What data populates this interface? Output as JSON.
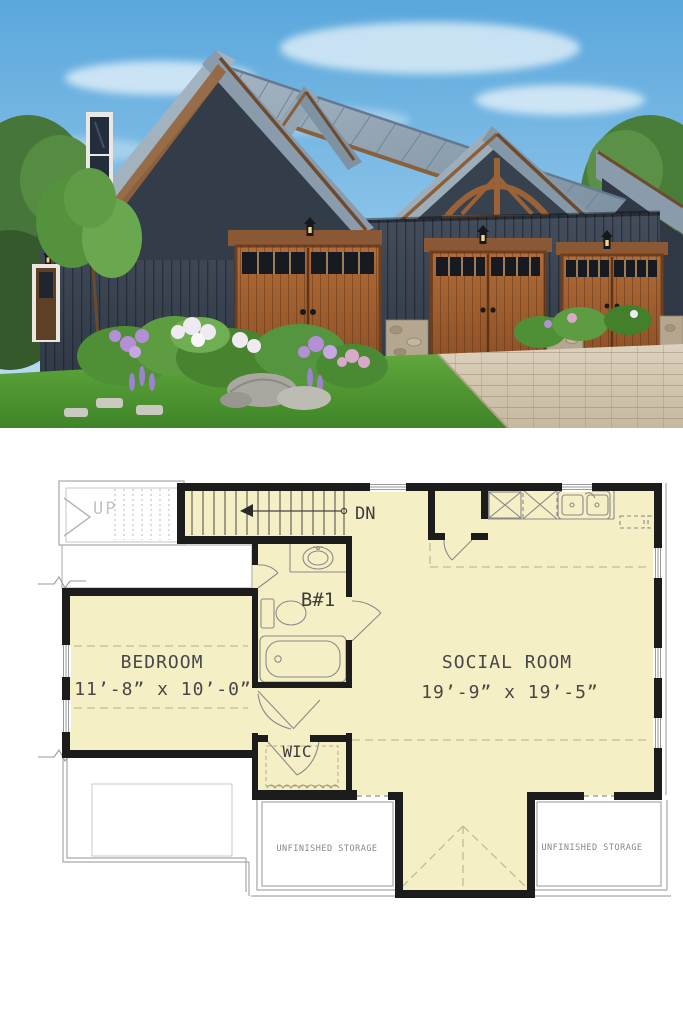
{
  "photo": {
    "subject": "barn-style-garage-apartment-exterior",
    "colors": {
      "sky": "#6db3e2",
      "clouds": "#ffffff",
      "metal_roof": "#93a4b3",
      "dark_siding": "#39424f",
      "wood_trim": "#96643c",
      "garage_doors": "#a3622f",
      "stone_piers": "#b5a78f",
      "grass": "#55a036",
      "driveway": "#d2c6b1",
      "flowers_purple": "#b48fd8",
      "flowers_white": "#efe9f2",
      "foliage": "#4f8f35"
    }
  },
  "floor_plan": {
    "colors": {
      "room_fill": "#f5efc5",
      "walls": "#1c1c1c",
      "thin_lines": "#9a9a9a",
      "label_text": "#474747",
      "storage_text": "#878787",
      "up_text": "#c2c2c2",
      "ceiling_dashes": "#c3bb96"
    },
    "labels": {
      "up": "UP",
      "down": "DN",
      "bath": "B#1",
      "wic": "WIC",
      "bedroom_name": "BEDROOM",
      "bedroom_dims": "11’-8” x 10’-0”",
      "social_name": "SOCIAL ROOM",
      "social_dims": "19’-9” x 19’-5”",
      "storage_left": "UNFINISHED STORAGE",
      "storage_right": "UNFINISHED STORAGE"
    }
  }
}
